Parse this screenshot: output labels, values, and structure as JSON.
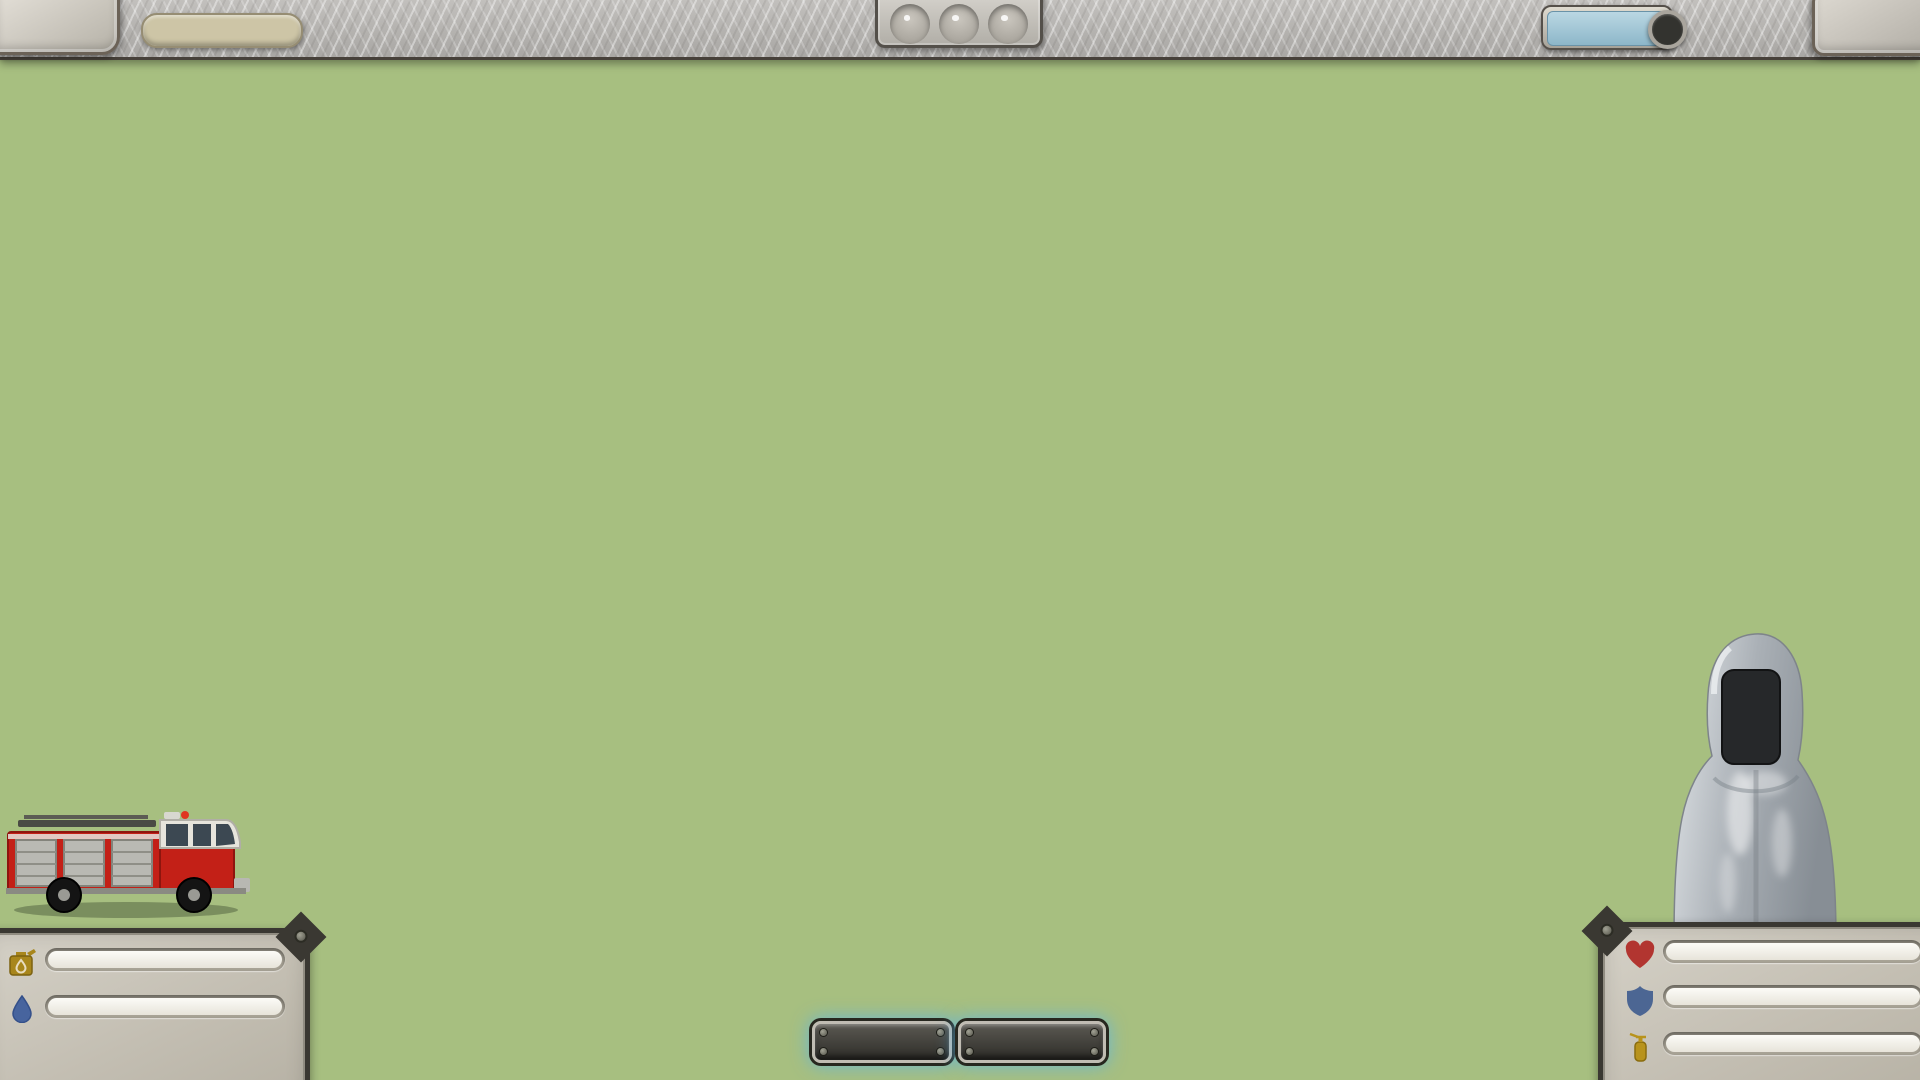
{
  "hud": {
    "loop_label": "LOOP 4",
    "xp": {
      "label": "504 / 1800 XP",
      "pct": 28,
      "color": "#5c2f4e",
      "color2": "#371a30"
    },
    "traffic_lights": [
      {
        "name": "light-1",
        "color": "red"
      },
      {
        "name": "light-2",
        "color": "red"
      },
      {
        "name": "light-3",
        "color": "green"
      }
    ],
    "blueprints": {
      "label": "BLUEPRINTS",
      "count": "3"
    },
    "money_label": "128 $"
  },
  "map": {
    "level_label": "Level5",
    "store_sign": "STORE",
    "roads": [
      [
        385,
        215,
        1700,
        215
      ],
      [
        370,
        218,
        370,
        500
      ],
      [
        248,
        500,
        645,
        500
      ],
      [
        248,
        500,
        248,
        665
      ],
      [
        240,
        665,
        1658,
        665
      ],
      [
        640,
        500,
        640,
        665
      ],
      [
        865,
        215,
        865,
        665
      ],
      [
        1105,
        585,
        1658,
        585
      ],
      [
        1105,
        585,
        1105,
        665
      ],
      [
        1655,
        585,
        1655,
        665
      ],
      [
        1445,
        215,
        1445,
        330
      ]
    ],
    "bottom_road": [
      0,
      930,
      1920,
      930
    ],
    "patches": [
      [
        95,
        185,
        88,
        48
      ],
      [
        62,
        300,
        56,
        36
      ],
      [
        158,
        266,
        46,
        28
      ],
      [
        588,
        300,
        78,
        46
      ],
      [
        642,
        382,
        62,
        36
      ],
      [
        905,
        142,
        30,
        18
      ],
      [
        420,
        345,
        40,
        22
      ],
      [
        745,
        178,
        36,
        20
      ],
      [
        1450,
        120,
        60,
        26
      ]
    ],
    "fences": [
      [
        118,
        283,
        175,
        125
      ],
      [
        58,
        373,
        205,
        130
      ],
      [
        570,
        403,
        155,
        100
      ],
      [
        1082,
        423,
        100,
        80
      ],
      [
        1172,
        423,
        100,
        80
      ],
      [
        1258,
        428,
        100,
        80
      ],
      [
        655,
        658,
        130,
        95
      ],
      [
        925,
        538,
        110,
        85
      ],
      [
        1165,
        568,
        130,
        95
      ],
      [
        1440,
        448,
        150,
        110
      ]
    ],
    "buildings": [
      {
        "x": 428,
        "y": 112,
        "w": 68,
        "h": 70,
        "roof": "#cf8a58",
        "wall": "#b98a4e"
      },
      {
        "x": 560,
        "y": 132,
        "w": 85,
        "h": 62,
        "roof": "#d29260",
        "wall": "#c9b896"
      },
      {
        "x": 722,
        "y": 108,
        "w": 112,
        "h": 106,
        "roof": "#9aa0a0",
        "wall": "#9a5b48"
      },
      {
        "x": 942,
        "y": 92,
        "w": 172,
        "h": 118,
        "roof": "#95a48c",
        "wall": "#9a5b48",
        "type": "firestation"
      },
      {
        "x": 1142,
        "y": 118,
        "w": 92,
        "h": 76,
        "roof": "#d29260",
        "wall": "#cfc3a8"
      },
      {
        "x": 1318,
        "y": 102,
        "w": 96,
        "h": 100,
        "roof": "#9aa0a0",
        "wall": "#9a5b48"
      },
      {
        "x": 1452,
        "y": 118,
        "w": 62,
        "h": 84,
        "roof": "#7fae8e",
        "wall": "#8a5240"
      },
      {
        "x": 1588,
        "y": 122,
        "w": 96,
        "h": 76,
        "roof": "#b0a89a",
        "wall": "#d8d2c6"
      },
      {
        "x": 1752,
        "y": 192,
        "w": 78,
        "h": 62,
        "roof": "#8fae9a",
        "wall": "#9a5b48"
      },
      {
        "x": 148,
        "y": 298,
        "w": 108,
        "h": 82,
        "roof": "#d0885c",
        "wall": "#e8e2d6"
      },
      {
        "x": 92,
        "y": 388,
        "w": 122,
        "h": 86,
        "roof": "#d0885c",
        "wall": "#e8e2d6"
      },
      {
        "x": 396,
        "y": 376,
        "w": 60,
        "h": 96,
        "roof": "#7fae8e",
        "wall": "#9a5b48",
        "type": "store"
      },
      {
        "x": 478,
        "y": 328,
        "w": 92,
        "h": 66,
        "roof": "#d29260",
        "wall": "#cfc3a8"
      },
      {
        "x": 598,
        "y": 418,
        "w": 96,
        "h": 76,
        "roof": "#d29260",
        "wall": "#cfc3a8"
      },
      {
        "x": 862,
        "y": 648,
        "w": 128,
        "h": 138,
        "roof": "#e9e9e5",
        "wall": "#2e5068",
        "type": "office"
      },
      {
        "x": 692,
        "y": 678,
        "w": 82,
        "h": 64,
        "roof": "#cf8a58",
        "wall": "#e0d8c8"
      },
      {
        "x": 552,
        "y": 552,
        "w": 72,
        "h": 56,
        "roof": "#cf8a58",
        "wall": "#e0d8c8"
      },
      {
        "x": 1092,
        "y": 438,
        "w": 78,
        "h": 62,
        "roof": "#d0885c",
        "wall": "#e8e2d6"
      },
      {
        "x": 1182,
        "y": 438,
        "w": 78,
        "h": 62,
        "roof": "#d0885c",
        "wall": "#e8e2d6"
      },
      {
        "x": 1268,
        "y": 443,
        "w": 78,
        "h": 62,
        "roof": "#d0885c",
        "wall": "#e8e2d6"
      },
      {
        "x": 1478,
        "y": 468,
        "w": 88,
        "h": 72,
        "roof": "#d0885c",
        "wall": "#e8e2d6"
      },
      {
        "x": 938,
        "y": 548,
        "w": 72,
        "h": 58,
        "roof": "#d0885c",
        "wall": "#e8e2d6"
      },
      {
        "x": 1188,
        "y": 583,
        "w": 88,
        "h": 72,
        "roof": "#d0885c",
        "wall": "#e8e2d6"
      },
      {
        "x": 948,
        "y": 712,
        "w": 52,
        "h": 30,
        "roof": "#9a5b48",
        "wall": "#7a4335"
      },
      {
        "x": 1668,
        "y": 648,
        "w": 60,
        "h": 88,
        "roof": "#c07a50",
        "wall": "#9a5b48"
      }
    ],
    "gas_station": {
      "x": 228,
      "y": 228,
      "w": 104,
      "h": 58
    },
    "pool": {
      "x": 948,
      "y": 642,
      "w": 58,
      "h": 66
    },
    "pond": {
      "cx": 1557,
      "cy": 737,
      "rx": 58,
      "ry": 42
    },
    "garden": {
      "x": 350,
      "y": 714,
      "w": 64,
      "h": 46
    },
    "flag": {
      "x": 302,
      "y": 698
    },
    "chimneys": [
      [
        1518,
        432,
        14,
        88
      ],
      [
        1238,
        366,
        12,
        104
      ]
    ],
    "map_truck": {
      "x": 352,
      "y": 222,
      "w": 58,
      "h": 20
    },
    "trees": [
      [
        398,
        152,
        13
      ],
      [
        520,
        182,
        11
      ],
      [
        672,
        172,
        15
      ],
      [
        700,
        148,
        11
      ],
      [
        915,
        182,
        13
      ],
      [
        1128,
        186,
        11
      ],
      [
        1256,
        158,
        13
      ],
      [
        1412,
        162,
        13
      ],
      [
        1540,
        178,
        11
      ],
      [
        1700,
        148,
        15
      ],
      [
        1728,
        112,
        11
      ],
      [
        1850,
        128,
        13
      ],
      [
        760,
        272,
        15
      ],
      [
        798,
        300,
        11
      ],
      [
        688,
        328,
        13
      ],
      [
        1000,
        358,
        11
      ],
      [
        930,
        390,
        13
      ],
      [
        1050,
        298,
        11
      ],
      [
        820,
        420,
        15
      ],
      [
        658,
        558,
        13
      ],
      [
        600,
        618,
        11
      ],
      [
        560,
        583,
        15
      ],
      [
        498,
        638,
        11
      ],
      [
        450,
        558,
        13
      ],
      [
        210,
        238,
        11
      ],
      [
        330,
        300,
        15
      ],
      [
        298,
        358,
        11
      ],
      [
        135,
        458,
        13
      ],
      [
        210,
        558,
        15
      ],
      [
        60,
        598,
        11
      ],
      [
        100,
        648,
        13
      ],
      [
        330,
        628,
        15
      ],
      [
        380,
        688,
        11
      ],
      [
        290,
        698,
        13
      ],
      [
        1558,
        638,
        13
      ],
      [
        1448,
        698,
        11
      ],
      [
        1348,
        678,
        13
      ],
      [
        148,
        778,
        11
      ],
      [
        62,
        758,
        14
      ],
      [
        905,
        505,
        12
      ],
      [
        1035,
        520,
        12
      ],
      [
        1148,
        532,
        11
      ]
    ],
    "pines": [
      [
        1332,
        268,
        16
      ],
      [
        1372,
        318,
        14
      ],
      [
        1300,
        388,
        18
      ],
      [
        1420,
        378,
        13
      ],
      [
        1352,
        448,
        15
      ],
      [
        1550,
        298,
        16
      ],
      [
        1600,
        368,
        14
      ],
      [
        1652,
        428,
        16
      ],
      [
        1582,
        478,
        13
      ],
      [
        1700,
        328,
        18
      ],
      [
        1752,
        418,
        14
      ],
      [
        1802,
        498,
        16
      ],
      [
        1868,
        398,
        13
      ],
      [
        1840,
        578,
        14
      ],
      [
        1762,
        558,
        13
      ],
      [
        1692,
        608,
        11
      ],
      [
        1905,
        318,
        14
      ],
      [
        962,
        328,
        16
      ],
      [
        1620,
        698,
        14
      ],
      [
        1875,
        668,
        15
      ],
      [
        1905,
        540,
        13
      ],
      [
        425,
        228,
        13
      ],
      [
        318,
        322,
        12
      ]
    ],
    "smoke": [
      [
        705,
        600,
        45,
        28,
        0.5
      ],
      [
        680,
        545,
        55,
        32,
        0.55
      ],
      [
        650,
        495,
        68,
        38,
        0.55
      ],
      [
        665,
        440,
        78,
        42,
        0.5
      ],
      [
        700,
        390,
        82,
        45,
        0.45
      ],
      [
        745,
        340,
        76,
        40,
        0.4
      ],
      [
        792,
        295,
        66,
        34,
        0.32
      ],
      [
        700,
        640,
        42,
        22,
        0.45
      ],
      [
        588,
        470,
        42,
        26,
        0.4
      ],
      [
        628,
        560,
        46,
        26,
        0.45
      ],
      [
        838,
        252,
        58,
        30,
        0.25
      ],
      [
        365,
        70,
        30,
        16,
        0.5
      ],
      [
        398,
        54,
        26,
        14,
        0.38
      ],
      [
        735,
        680,
        50,
        24,
        0.35
      ]
    ],
    "plumes": [
      [
        716,
        450,
        10,
        84
      ],
      [
        594,
        503,
        9,
        80
      ],
      [
        348,
        80,
        9,
        60
      ]
    ],
    "glows": [
      [
        468,
        130,
        62
      ],
      [
        735,
        706,
        72
      ],
      [
        602,
        556,
        55
      ],
      [
        880,
        640,
        55
      ],
      [
        372,
        120,
        45
      ]
    ],
    "markers": {
      "houses": [
        [
          793,
          72
        ],
        [
          848,
          594
        ],
        [
          690,
          652
        ],
        [
          1210,
          562
        ]
      ],
      "flames": [
        [
          876,
          594
        ],
        [
          720,
          654
        ],
        [
          455,
          90
        ],
        [
          592,
          530
        ],
        [
          372,
          103
        ]
      ],
      "hydrants": [
        [
          858,
          232
        ],
        [
          1345,
          598
        ],
        [
          378,
          420
        ],
        [
          1098,
          668
        ]
      ]
    }
  },
  "cards": [
    {
      "title": "ERASER",
      "count": "2",
      "desc": "Erases anything on the map. Problem? What problem?",
      "art": "eraser"
    },
    {
      "title": "HILL",
      "count": "1",
      "desc": "Adds extra HP.",
      "art": "hill",
      "badge_tl": {
        "text": "+2",
        "icon": "heart",
        "color": "#3e7a41"
      }
    },
    {
      "title": "AXE",
      "count": "4",
      "desc": "Firefighter axe",
      "art": "axe",
      "badge_tl": {
        "text": "+3",
        "icon": "extinguisher",
        "color": "#e0555e"
      }
    },
    {
      "title": "HOUSE",
      "count": "1",
      "desc": "The American dream... until the grill catches fire.",
      "art": "house",
      "badge_tl": {
        "text": "35",
        "icon": "house",
        "color": "#34517a"
      },
      "badge_bl": {
        "text": "6",
        "icon": "dot",
        "color": "#c43a36"
      },
      "badge_br": {
        "text": "22 XP",
        "color": "#7b3f8e"
      }
    },
    {
      "title": "ERASER",
      "count": "2",
      "desc": "Erases anything on the map. Problem? What problem?",
      "art": "eraser"
    },
    {
      "title": "ERASER",
      "count": "3",
      "desc": "Erases anything on the map. Problem? What problem?",
      "art": "eraser"
    },
    {
      "title": "K 3",
      "count": "5",
      "desc": "",
      "art": "helmet",
      "partial": true
    },
    {
      "title": "",
      "count": "1",
      "desc": "P.",
      "art": "hill",
      "partial": true
    }
  ],
  "resources": {
    "fuel": {
      "label": "Fuel: 103 / 150 l",
      "pct": 69,
      "color": "#d9a51c",
      "color2": "#a87908"
    },
    "water": {
      "label": "Water : 0 / 500 l",
      "pct": 6,
      "color": "#9fb4ba",
      "color2": "#7392a0"
    }
  },
  "stats": {
    "health": {
      "label": "Health : 113 / 113",
      "pct": 100,
      "color": "#bb3d36",
      "color2": "#93271f"
    },
    "protection": {
      "label": "Protection : 10",
      "pct": 52,
      "color": "#5a719f",
      "color2": "#3f527c"
    },
    "extinguish": {
      "label": "Extinguish : 9",
      "pct": 21,
      "color": "#cf9f22",
      "color2": "#a87c0e"
    }
  },
  "actions": {
    "stop": "STOP",
    "evacuate": "EVACUATE"
  }
}
